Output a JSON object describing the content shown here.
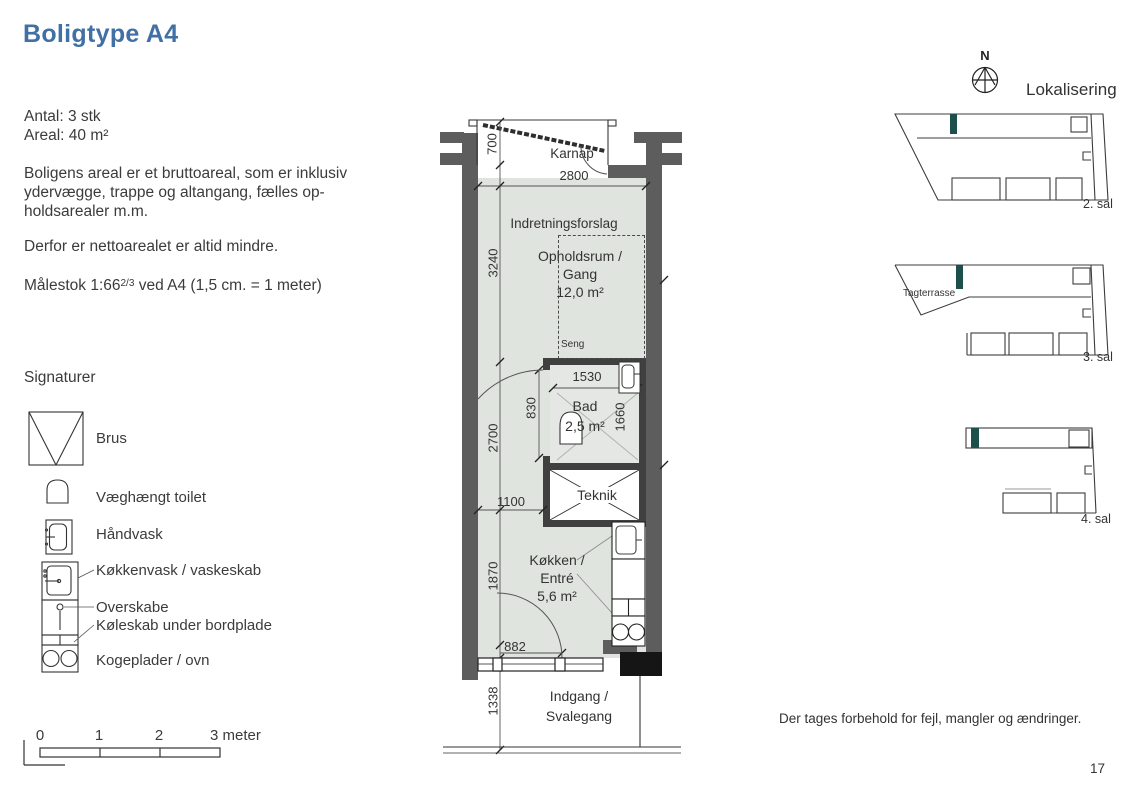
{
  "page": {
    "title": "Boligtype A4",
    "disclaimer": "Der tages forbehold for fejl, mangler og ændringer.",
    "page_number": "17"
  },
  "info": {
    "antal": "Antal: 3 stk",
    "areal": "Areal: 40 m²",
    "paragraph1": [
      "Boligens areal er et bruttoareal, som er inklusiv",
      "ydervægge, trappe og altangang, fælles op-",
      "holdsarealer m.m."
    ],
    "paragraph2": "Derfor er nettoarealet er altid mindre.",
    "scale_note_prefix": "Målestok 1:66",
    "scale_note_fraction": "2/3",
    "scale_note_suffix": " ved A4 (1,5 cm. = 1 meter)"
  },
  "signaturer": {
    "title": "Signaturer",
    "items": [
      {
        "label": "Brus",
        "icon": "shower-symbol"
      },
      {
        "label": "Væghængt toilet",
        "icon": "wall-hung-toilet-symbol"
      },
      {
        "label": "Håndvask",
        "icon": "hand-basin-symbol"
      },
      {
        "label": "Køkkenvask / vaskeskab",
        "icon": "kitchen-sink-symbol"
      },
      {
        "label": "Overskabe",
        "icon": "overhead-cabinet-symbol"
      },
      {
        "label": "Køleskab under bordplade",
        "icon": "under-counter-fridge-symbol"
      },
      {
        "label": "Kogeplader / ovn",
        "icon": "cooktop-oven-symbol"
      }
    ]
  },
  "scalebar": {
    "labels": [
      "0",
      "1",
      "2"
    ],
    "end_label": "3 meter"
  },
  "plan": {
    "rooms": {
      "karnap": "Karnap",
      "indretningsforslag": "Indretningsforslag",
      "opholdsrum_line1": "Opholdsrum /",
      "opholdsrum_line2": "Gang",
      "opholdsrum_area": "12,0 m²",
      "seng": "Seng",
      "bad": "Bad",
      "bad_area": "2,5 m²",
      "teknik": "Teknik",
      "kokken_line1": "Køkken /",
      "kokken_line2": "Entré",
      "kokken_area": "5,6 m²",
      "indgang_line1": "Indgang /",
      "indgang_line2": "Svalegang"
    },
    "dimensions": {
      "karnap_depth": "700",
      "width_top": "2800",
      "left_upper": "3240",
      "bad_width": "1530",
      "bad_door": "830",
      "bad_height": "1660",
      "left_middle": "2700",
      "teknik_offset": "1100",
      "left_lower": "1870",
      "entry_door": "882",
      "svalegang_depth": "1338"
    }
  },
  "lokalisering": {
    "title": "Lokalisering",
    "north_label": "N",
    "levels": [
      {
        "label": "2. sal"
      },
      {
        "label": "3. sal",
        "annotation": "Tagterrasse"
      },
      {
        "label": "4. sal"
      }
    ]
  },
  "colors": {
    "accent_blue": "#4170a4",
    "floor_fill": "#e0e4df",
    "wall_gray": "#5d5d5d",
    "wall_dark": "#404040",
    "marker_teal": "#1d4f4b"
  }
}
